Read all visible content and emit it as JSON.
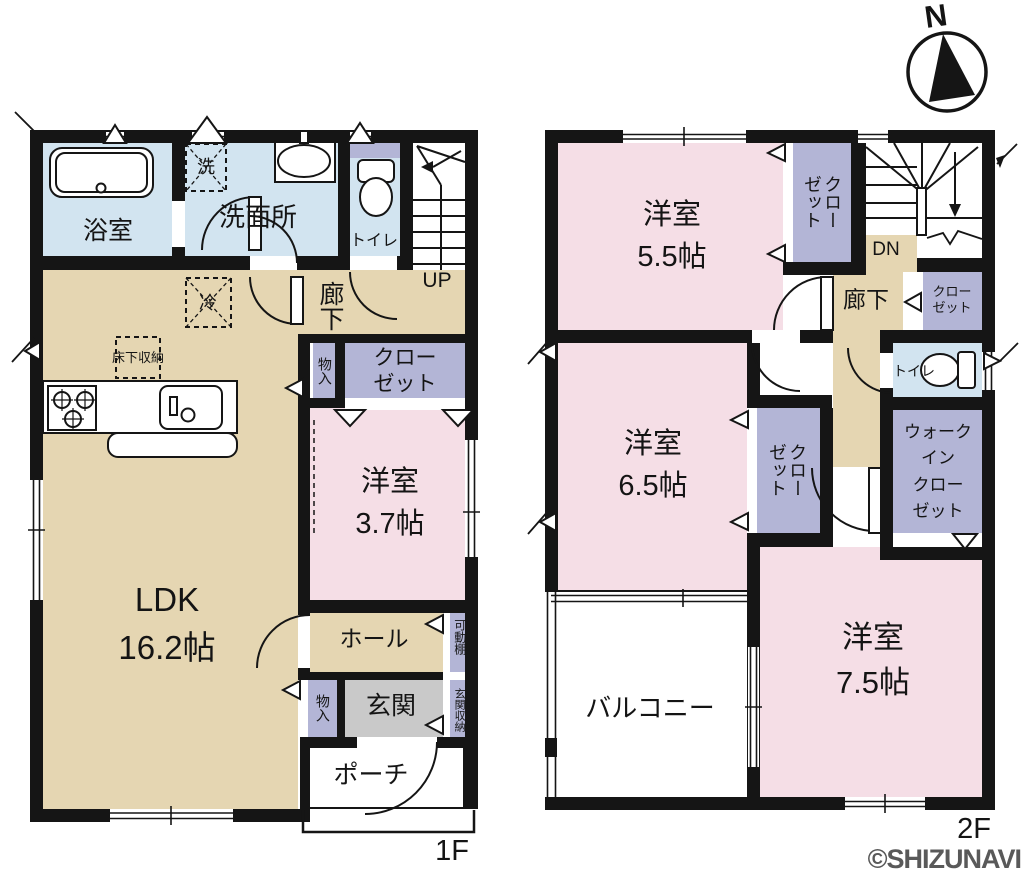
{
  "palette": {
    "wall": "#151515",
    "pink": "#f5dee6",
    "tan": "#e5d6b2",
    "blue": "#d2e4f0",
    "purple": "#b3b5d6",
    "gray": "#c9c9c9",
    "watermark_gray": "#595959"
  },
  "compass": {
    "north_label": "N"
  },
  "watermark": {
    "text": "©SHIZUNAVI"
  },
  "floor1": {
    "floor_label": "1F",
    "bathroom": "浴室",
    "washer_box": "洗",
    "washroom": "洗面所",
    "toilet": "トイレ",
    "stairs_label": "UP",
    "hallway": "廊下",
    "storage_upper": "物入",
    "closet": "クローゼット",
    "fridge_box": "冷",
    "underfloor_storage": "床下収納",
    "western_room": {
      "name": "洋室",
      "size": "3.7帖"
    },
    "ldk": {
      "name": "LDK",
      "size": "16.2帖"
    },
    "hall": "ホール",
    "storage_lower": "物入",
    "entrance": "玄関",
    "movable_shelf": "可動棚",
    "entrance_storage": "玄関収納",
    "porch": "ポーチ"
  },
  "floor2": {
    "floor_label": "2F",
    "room_55": {
      "name": "洋室",
      "size": "5.5帖"
    },
    "closet_55": "クローゼット",
    "stairs_label": "DN",
    "hallway": "廊下",
    "closet_hall": "クローゼット",
    "toilet": "トイレ",
    "room_65": {
      "name": "洋室",
      "size": "6.5帖"
    },
    "closet_65": "クローゼット",
    "walk_in_closet": {
      "lines": [
        "ウォーク",
        "イン",
        "クロー",
        "ゼット"
      ]
    },
    "room_75": {
      "name": "洋室",
      "size": "7.5帖"
    },
    "balcony": "バルコニー"
  }
}
